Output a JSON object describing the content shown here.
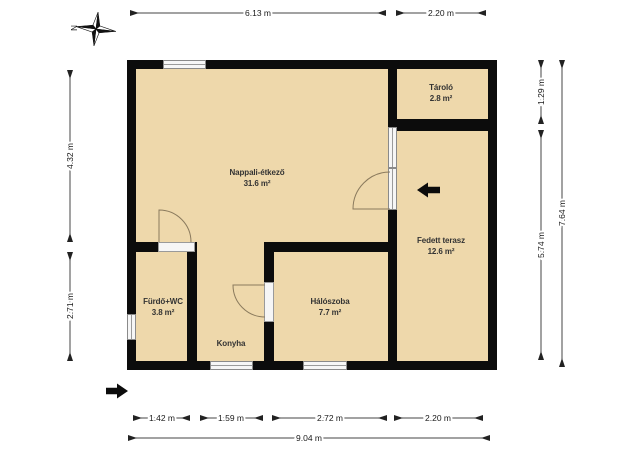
{
  "compass": {
    "label": "N"
  },
  "rooms": {
    "nappali": {
      "name": "Nappali-étkező",
      "area": "31.6 m²"
    },
    "tarolo": {
      "name": "Tároló",
      "area": "2.8 m²"
    },
    "terasz": {
      "name": "Fedett terasz",
      "area": "12.6 m²"
    },
    "furdo": {
      "name": "Fürdő+WC",
      "area": "3.8 m²"
    },
    "haloszoba": {
      "name": "Hálószoba",
      "area": "7.7 m²"
    },
    "konyha": {
      "name": "Konyha"
    }
  },
  "dimensions": {
    "top_main": "6.13 m",
    "top_right": "2.20 m",
    "left_upper": "4.32 m",
    "left_lower": "2.71 m",
    "right_tarolo": "1.29 m",
    "right_terasz": "5.74 m",
    "right_total": "7.64 m",
    "bottom_furdo": "1.42 m",
    "bottom_konyha": "1.59 m",
    "bottom_halo": "2.72 m",
    "bottom_terasz": "2.20 m",
    "bottom_total": "9.04 m"
  },
  "colors": {
    "floor": "#eed8ab",
    "wall": "#0c0c0c",
    "opening": "#f6f6f6",
    "dimension_text": "#1a1a1a"
  }
}
